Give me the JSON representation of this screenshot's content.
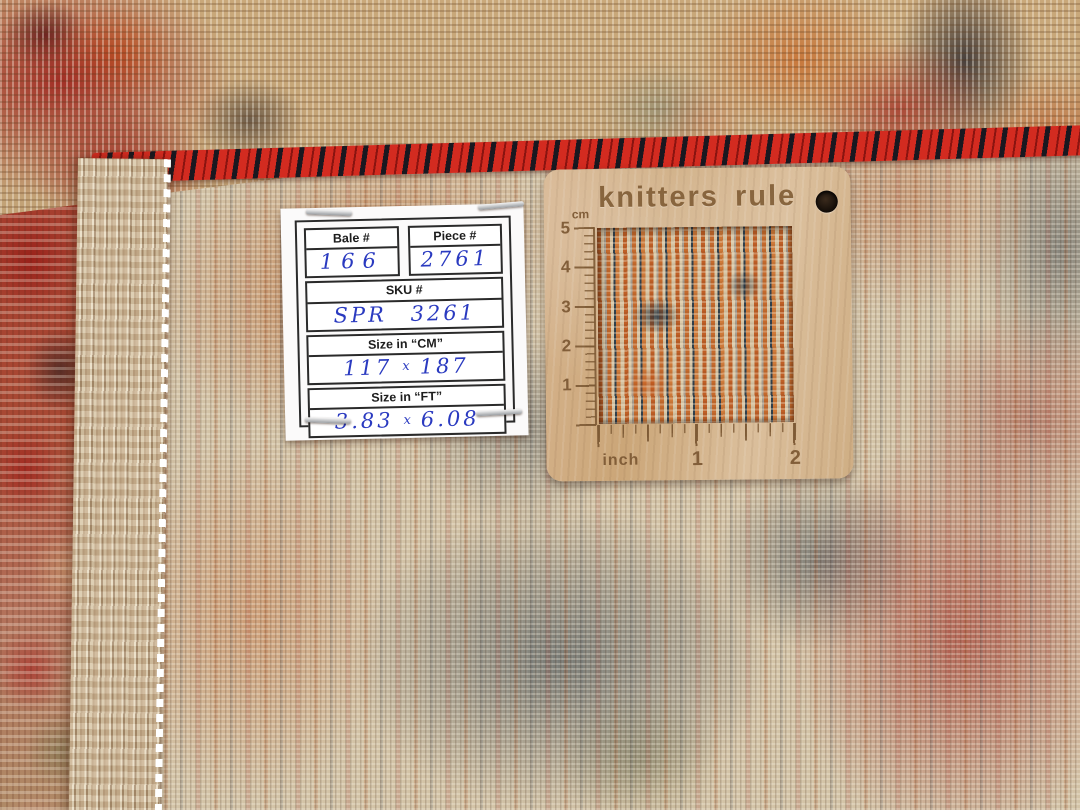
{
  "label_card": {
    "bale": {
      "header": "Bale #",
      "value": "166"
    },
    "piece": {
      "header": "Piece #",
      "value": "2761"
    },
    "sku": {
      "header": "SKU #",
      "value": "SPR 3261"
    },
    "size_cm": {
      "header": "Size in “CM”",
      "width": "117",
      "sep": "x",
      "height": "187"
    },
    "size_ft": {
      "header": "Size in “FT”",
      "width": "3.83",
      "sep": "x",
      "height": "6.08"
    }
  },
  "ruler": {
    "brand": "knitters rule",
    "cm_label": "cm",
    "cm_ticks": [
      "5",
      "4",
      "3",
      "2",
      "1"
    ],
    "inch_label": "inch",
    "inch_ticks": [
      "1",
      "2"
    ]
  },
  "colors": {
    "rug_cream": "#d3c3a6",
    "rug_rust": "#b85c28",
    "rug_navy": "#2c3e4d",
    "rug_red": "#a62a22",
    "selvage_red": "#d32b20",
    "fringe_beige": "#d9c7a8",
    "wood": "#d2af86",
    "engraving": "#7d5a35",
    "paper": "#fbfafa",
    "ink_blue": "#2a3ac0",
    "print_black": "#2a2a2a"
  }
}
